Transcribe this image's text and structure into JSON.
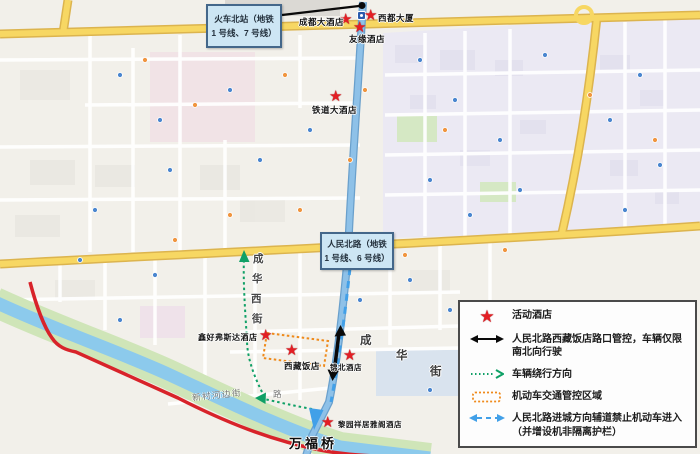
{
  "glyphs": {
    "star": "★"
  },
  "callouts": {
    "north_station": {
      "line1": "火车北站（地铁",
      "line2": "1 号线、7 号线）"
    },
    "renmin_north_road": {
      "line1": "人民北路（地铁",
      "line2": "1 号线、6 号线）"
    }
  },
  "hotels": [
    {
      "name": "成都大酒店"
    },
    {
      "name": "西都大厦"
    },
    {
      "name": "友缘酒店"
    },
    {
      "name": "铁道大酒店"
    },
    {
      "name": "鑫好弗斯达酒店"
    },
    {
      "name": "西藏饭店"
    },
    {
      "name": "锦北酒店"
    },
    {
      "name": "黎园祥居雅阁酒店"
    }
  ],
  "streets": {
    "chenghua_west": [
      "成",
      "华",
      "西",
      "街"
    ],
    "chenghua": [
      "成",
      "华",
      "街"
    ],
    "xincun_riverside": "新村河边街",
    "lu": "路",
    "wanfu_bridge": "万福桥"
  },
  "legend": {
    "items": [
      {
        "icon": "star-icon",
        "label": "活动酒店"
      },
      {
        "icon": "double-arrow-icon",
        "label": "人民北路西藏饭店路口管控，车辆仅限南北向行驶"
      },
      {
        "icon": "dotted-arrow-icon",
        "label": "车辆绕行方向"
      },
      {
        "icon": "dotted-rect-icon",
        "label": "机动车交通管控区域"
      },
      {
        "icon": "blue-dash-arrow-icon",
        "label": "人民北路进城方向辅道禁止机动车进入（并增设机非隔离护栏）"
      }
    ]
  },
  "colors": {
    "star": "#e31e24",
    "control_zone": "#ef8a1b",
    "bypass_route": "#0fa066",
    "lane_closure": "#42a0e8",
    "highway": "#f7d763",
    "main_road": "#8ec1e8",
    "red_route": "#d8232a"
  }
}
